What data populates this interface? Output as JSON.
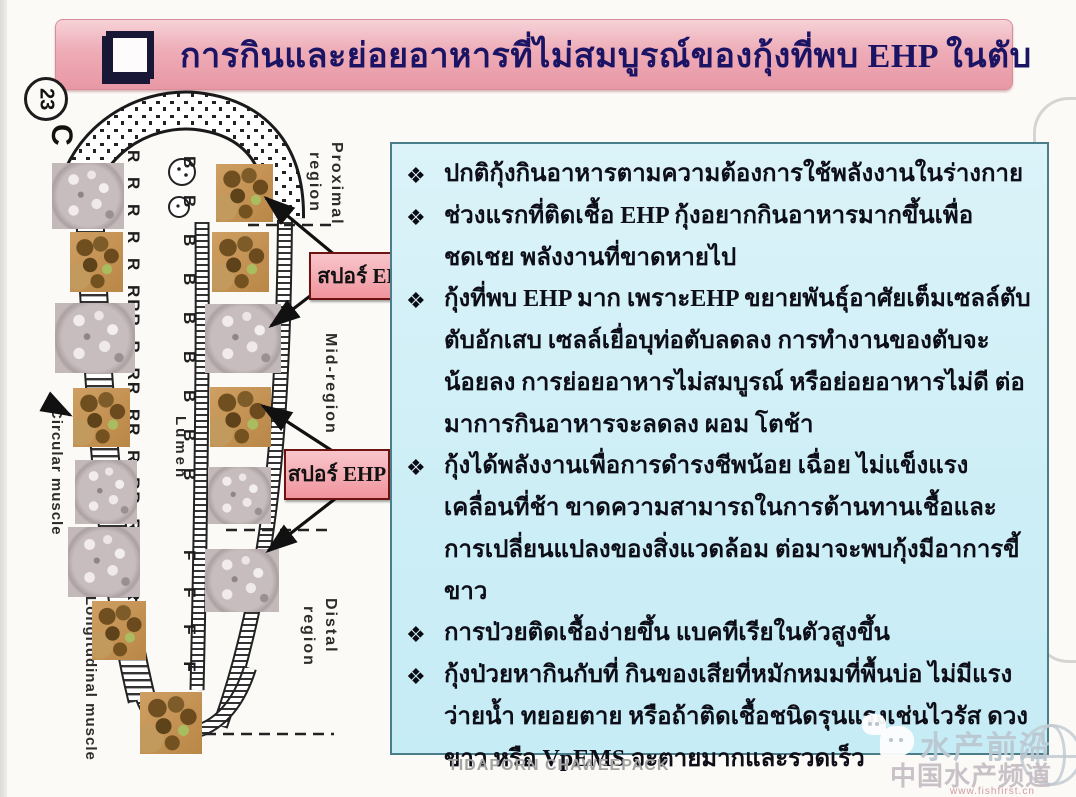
{
  "slide": {
    "number": "23",
    "corner_letter": "C",
    "title": "การกินและย่อยอาหารที่ไม่สมบูรณ์ของกุ้งที่พบ EHP ในตับ"
  },
  "diagram": {
    "labels": {
      "proximal_line1": "Proximal",
      "proximal_line2": "region",
      "mid": "Mid-region",
      "distal_line1": "Distal",
      "distal_line2": "region",
      "circular_muscle": "Circular muscle",
      "longitudinal_muscle": "Longitudinal muscle",
      "lumen": "Lumen"
    },
    "cell_letters": {
      "r_column": "R R R R R RRR R RR RR R RR RRRR RRR",
      "b_column": "B B B B B B B B B",
      "f_column": "F F F F F F"
    },
    "spore_label_1": "สปอร์ EHP",
    "spore_label_2": "สปอร์ EHP"
  },
  "content": {
    "bullet_glyph": "❖",
    "bullets": [
      "ปกติกุ้งกินอาหารตามความต้องการใช้พลังงานในร่างกาย",
      "ช่วงแรกที่ติดเชื้อ EHP กุ้งอยากกินอาหารมากขึ้นเพื่อชดเชย พลังงานที่ขาดหายไป",
      "กุ้งที่พบ EHP มาก เพราะEHP ขยายพันธุ์อาศัยเต็มเซลล์ตับ ตับอักเสบ เซลล์เยื่อบุท่อตับลดลง การทำงานของตับจะน้อยลง การย่อยอาหารไม่สมบูรณ์ หรือย่อยอาหารไม่ดี ต่อมาการกินอาหารจะลดลง ผอม โตช้า",
      "กุ้งได้พลังงานเพื่อการดำรงชีพน้อย  เฉื่อย ไม่แข็งแรงเคลื่อนที่ช้า ขาดความสามารถในการต้านทานเชื้อและการเปลี่ยนแปลงของสิ่งแวดล้อม ต่อมาจะพบกุ้งมีอาการขี้ขาว",
      "การป่วยติดเชื้อง่ายขึ้น แบคทีเรียในตัวสูงขึ้น",
      "กุ้งป่วยหากินกับที่ กินของเสียที่หมักหมมที่พื้นบ่อ ไม่มีแรงว่ายน้ำ ทยอยตาย หรือถ้าติดเชื้อชนิดรุนแรงเช่นไวรัส ดวงขาว หรือ VpEMS จะตายมากและรวดเร็ว"
    ]
  },
  "footer": {
    "author": "TIDAPORN CHAWEEPACK"
  },
  "watermark": {
    "line1": "水产前沿",
    "line2": "中国水产频道",
    "url": "www.fishfirst.cn"
  },
  "colors": {
    "title_bg": "#eeacb7",
    "title_text": "#1b1464",
    "content_box_bg": "#d4f0f7",
    "content_box_border": "#4b7d8a",
    "spore_label_bg": "#f3a9b0",
    "spore_label_border": "#6e1212",
    "body_text": "#0e0e18"
  }
}
